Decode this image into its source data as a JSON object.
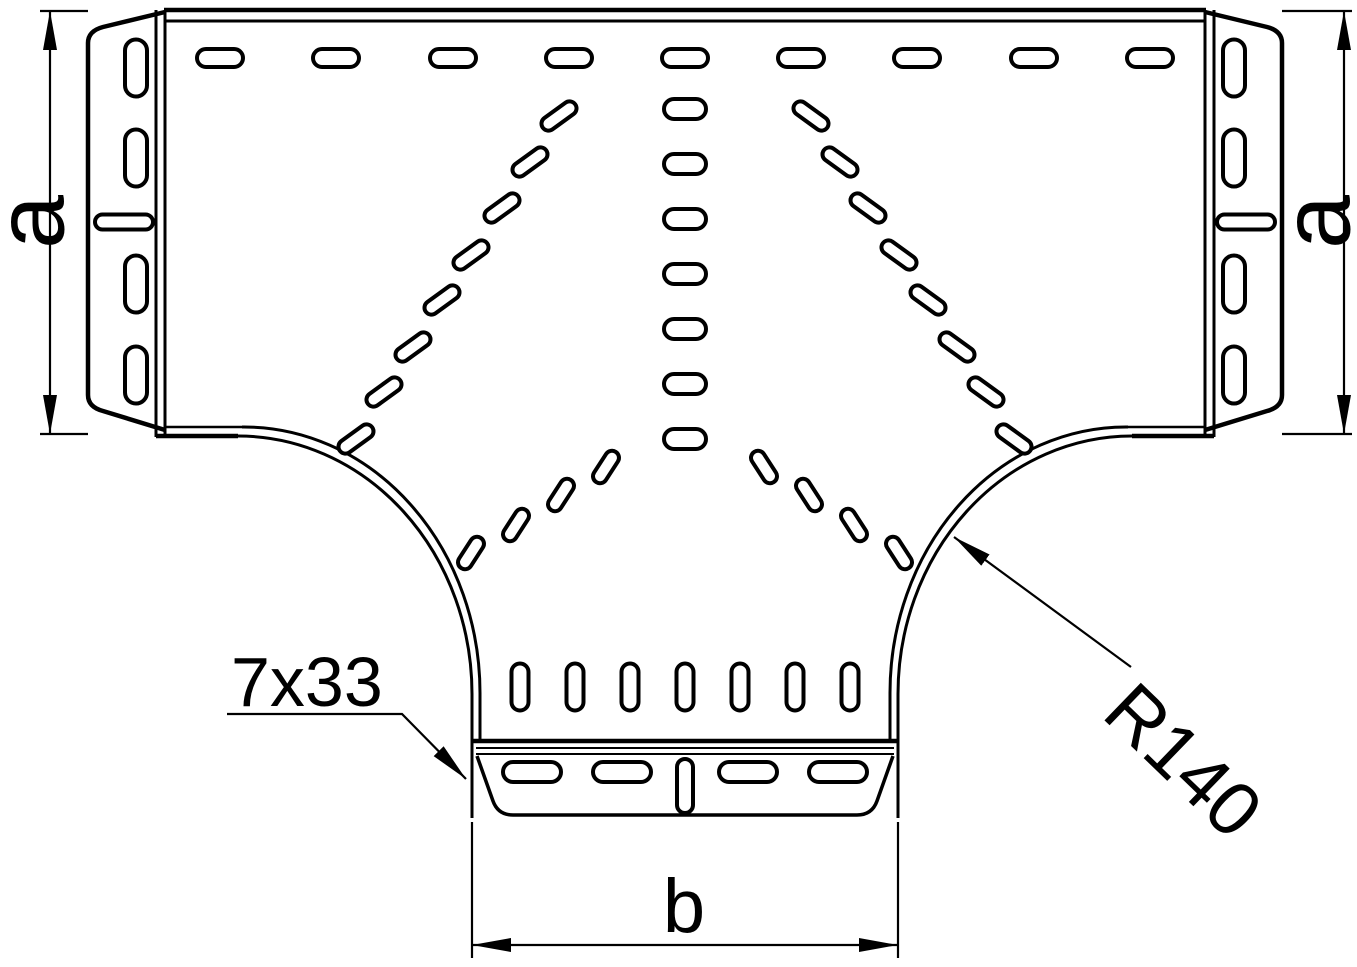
{
  "drawing": {
    "type": "technical-drawing",
    "subject": "perforated cable tray tee fitting, top view",
    "background": "#ffffff",
    "line_color": "#000000"
  },
  "labels": {
    "dim_a_left": "a",
    "dim_a_right": "a",
    "dim_b": "b",
    "slot_spec": "7x33",
    "radius": "R140"
  },
  "slot_groups": [
    {
      "name": "top-row-slot",
      "w": 46,
      "h": 18,
      "angle": 0,
      "centers": [
        [
          220,
          58
        ],
        [
          336,
          58
        ],
        [
          453,
          58
        ],
        [
          569,
          58
        ],
        [
          685,
          58
        ],
        [
          801,
          58
        ],
        [
          917,
          58
        ],
        [
          1034,
          58
        ],
        [
          1150,
          58
        ]
      ]
    },
    {
      "name": "center-column-slot",
      "w": 42,
      "h": 20,
      "angle": 0,
      "centers": [
        [
          685,
          109
        ],
        [
          685,
          164
        ],
        [
          685,
          219
        ],
        [
          685,
          274
        ],
        [
          685,
          329
        ],
        [
          685,
          384
        ],
        [
          685,
          439
        ]
      ]
    },
    {
      "name": "left-flange-slot-vertical",
      "w": 22,
      "h": 57,
      "angle": 0,
      "centers": [
        [
          136,
          68
        ],
        [
          136,
          158
        ],
        [
          136,
          284
        ],
        [
          136,
          375
        ]
      ]
    },
    {
      "name": "left-flange-slot-horizontal",
      "w": 58,
      "h": 15,
      "angle": 0,
      "centers": [
        [
          124,
          222
        ]
      ]
    },
    {
      "name": "right-flange-slot-vertical",
      "w": 22,
      "h": 57,
      "angle": 0,
      "centers": [
        [
          1234,
          68
        ],
        [
          1234,
          158
        ],
        [
          1234,
          284
        ],
        [
          1234,
          375
        ]
      ]
    },
    {
      "name": "right-flange-slot-horizontal",
      "w": 58,
      "h": 15,
      "angle": 0,
      "centers": [
        [
          1246,
          222
        ]
      ]
    },
    {
      "name": "left-fan-slot",
      "w": 40,
      "h": 14,
      "angle": -36,
      "centers": [
        [
          559,
          116
        ],
        [
          530,
          162
        ],
        [
          502,
          208
        ],
        [
          471,
          255
        ],
        [
          442,
          300
        ],
        [
          413,
          347
        ],
        [
          384,
          392
        ],
        [
          356,
          439
        ]
      ]
    },
    {
      "name": "right-fan-slot",
      "w": 40,
      "h": 14,
      "angle": 36,
      "centers": [
        [
          811,
          116
        ],
        [
          840,
          162
        ],
        [
          868,
          208
        ],
        [
          899,
          255
        ],
        [
          928,
          300
        ],
        [
          957,
          347
        ],
        [
          986,
          392
        ],
        [
          1014,
          439
        ]
      ]
    },
    {
      "name": "left-inner-arc-slot",
      "w": 36,
      "h": 14,
      "angle": -57,
      "centers": [
        [
          606,
          467
        ],
        [
          561,
          495
        ],
        [
          516,
          525
        ],
        [
          471,
          553
        ]
      ]
    },
    {
      "name": "right-inner-arc-slot",
      "w": 36,
      "h": 14,
      "angle": 57,
      "centers": [
        [
          764,
          467
        ],
        [
          809,
          495
        ],
        [
          854,
          525
        ],
        [
          899,
          553
        ]
      ]
    },
    {
      "name": "branch-row-slot",
      "w": 17,
      "h": 47,
      "angle": 0,
      "centers": [
        [
          520,
          687
        ],
        [
          575,
          687
        ],
        [
          630,
          687
        ],
        [
          685,
          687
        ],
        [
          740,
          687
        ],
        [
          795,
          687
        ],
        [
          850,
          687
        ]
      ]
    },
    {
      "name": "bottom-flange-slot-horizontal",
      "w": 58,
      "h": 20,
      "angle": 0,
      "centers": [
        [
          532,
          772
        ],
        [
          622,
          772
        ],
        [
          748,
          772
        ],
        [
          838,
          772
        ]
      ]
    },
    {
      "name": "bottom-flange-slot-vertical",
      "w": 16,
      "h": 54,
      "angle": 0,
      "centers": [
        [
          685,
          786
        ]
      ]
    }
  ]
}
